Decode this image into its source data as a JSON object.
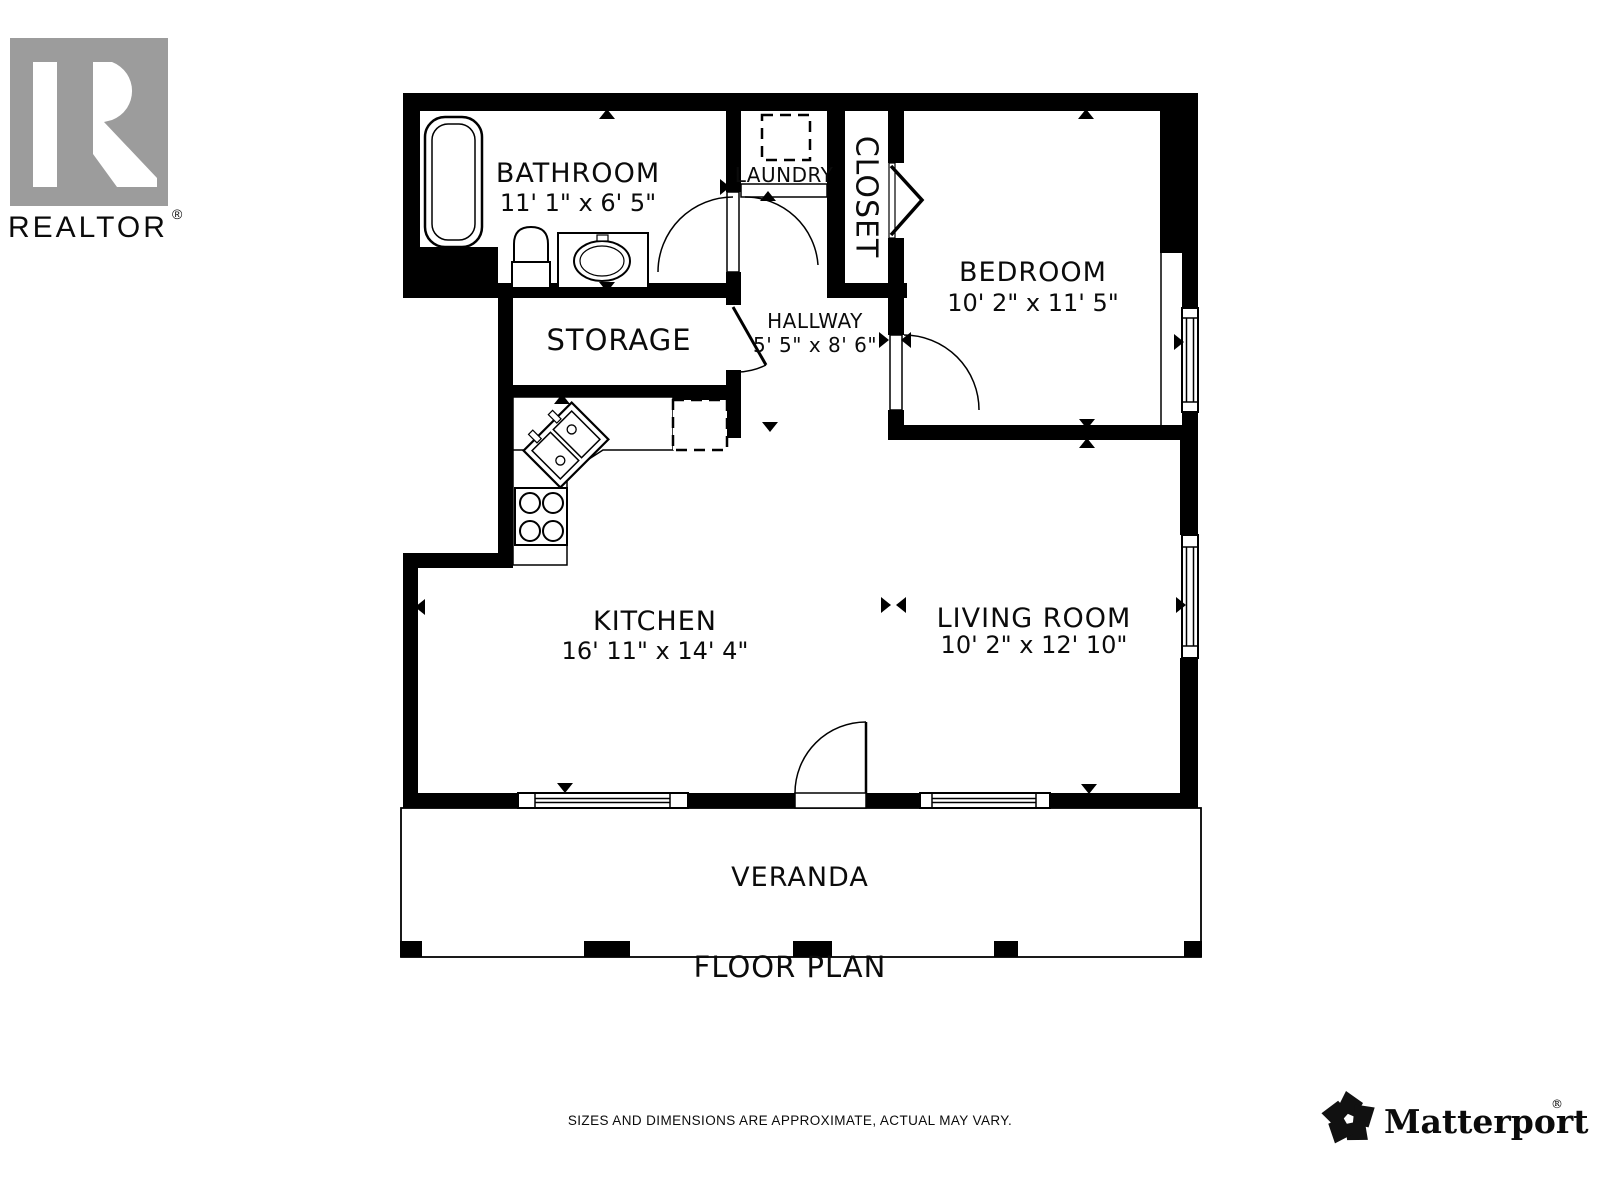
{
  "branding": {
    "realtor": {
      "monogram": "R",
      "label": "REALTOR",
      "registered": "®"
    },
    "matterport": {
      "label": "Matterport",
      "registered": "®"
    }
  },
  "rooms": {
    "bathroom": {
      "name": "BATHROOM",
      "dims": "11' 1\" x 6' 5\""
    },
    "laundry": {
      "name": "LAUNDRY"
    },
    "closet": {
      "name": "CLOSET"
    },
    "bedroom": {
      "name": "BEDROOM",
      "dims": "10' 2\" x 11' 5\""
    },
    "storage": {
      "name": "STORAGE"
    },
    "hallway": {
      "name": "HALLWAY",
      "dims": "5' 5\" x 8' 6\""
    },
    "kitchen": {
      "name": "KITCHEN",
      "dims": "16' 11\" x 14' 4\""
    },
    "living_room": {
      "name": "LIVING ROOM",
      "dims": "10' 2\" x 12' 10\""
    },
    "veranda": {
      "name": "VERANDA"
    }
  },
  "title": "FLOOR PLAN",
  "disclaimer": "SIZES AND DIMENSIONS ARE APPROXIMATE, ACTUAL MAY VARY.",
  "colors": {
    "wall": "#000000",
    "logo_gray": "#9c9c9c",
    "disclaimer_gray": "#7d7d7d"
  }
}
